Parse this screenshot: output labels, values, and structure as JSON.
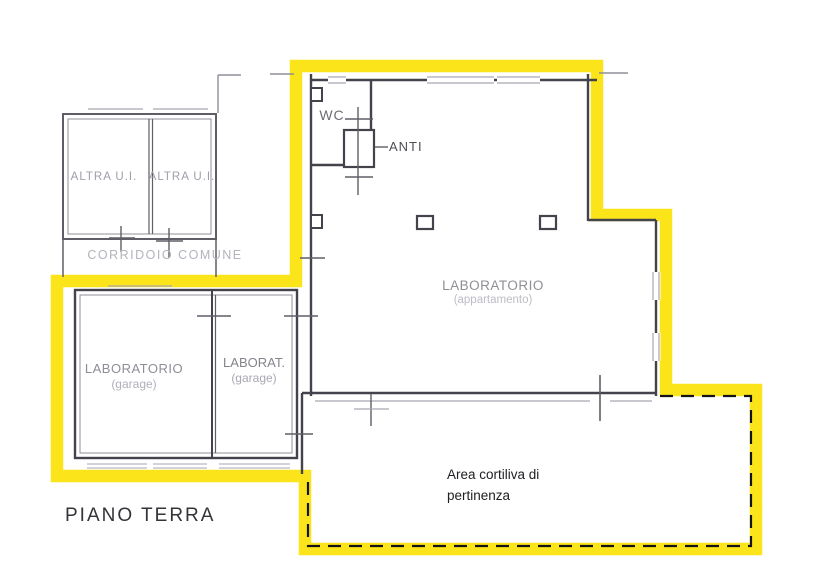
{
  "title": "PIANO TERRA",
  "colors": {
    "highlight": "#FBE41A",
    "dash": "#141414",
    "wall": "#43434B",
    "wall_mid": "#5E5E66",
    "wall_light": "#8F8F9A",
    "sill": "#A6A6B0"
  },
  "labels": {
    "wc": "WC",
    "anti": "ANTI",
    "altra_1": "ALTRA U.I.",
    "altra_2": "ALTRA U.I.",
    "corridoio": "CORRIDOIO COMUNE",
    "laboratorio_app": "LABORATORIO",
    "laboratorio_app_sub": "(appartamento)",
    "laboratorio_garage": "LABORATORIO",
    "laboratorio_garage_sub": "(garage)",
    "laborat_garage": "LABORAT.",
    "laborat_garage_sub": "(garage)",
    "area_cortiliva_1": "Area cortiliva di",
    "area_cortiliva_2": "pertinenza",
    "floor": "PIANO TERRA"
  }
}
